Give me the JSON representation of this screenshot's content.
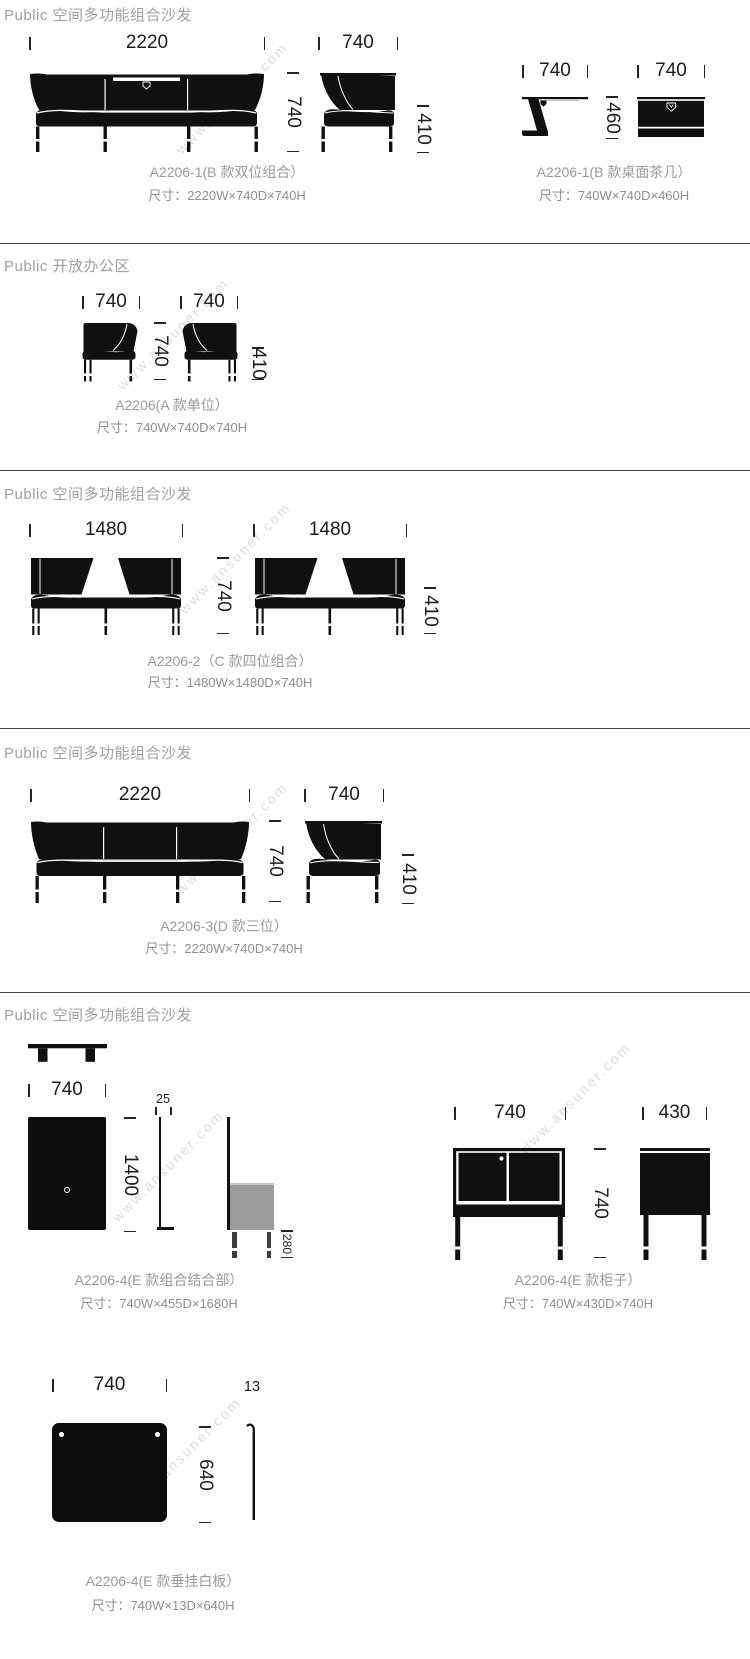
{
  "watermark": "www.ansuner.com",
  "sections": [
    {
      "title": "Public 空间多功能组合沙发",
      "groups": [
        {
          "name": "A2206-1(B 款双位组合）",
          "size": "尺寸：2220W×740D×740H",
          "dims": {
            "width": "2220",
            "height": "740",
            "side_width": "740",
            "seat_height": "410"
          }
        },
        {
          "name": "A2206-1(B 款桌面茶几）",
          "size": "尺寸：740W×740D×460H",
          "dims": {
            "side_width": "740",
            "front_width": "740",
            "height": "460"
          }
        }
      ]
    },
    {
      "title": "Public 开放办公区",
      "groups": [
        {
          "name": "A2206(A 款单位）",
          "size": "尺寸：740W×740D×740H",
          "dims": {
            "front_width": "740",
            "side_width": "740",
            "height": "740",
            "seat_height": "410"
          }
        }
      ]
    },
    {
      "title": "Public 空间多功能组合沙发",
      "groups": [
        {
          "name": "A2206-2（C 款四位组合）",
          "size": "尺寸：1480W×1480D×740H",
          "dims": {
            "width_a": "1480",
            "width_b": "1480",
            "height": "740",
            "seat_height": "410"
          }
        }
      ]
    },
    {
      "title": "Public 空间多功能组合沙发",
      "groups": [
        {
          "name": "A2206-3(D 款三位）",
          "size": "尺寸：2220W×740D×740H",
          "dims": {
            "width": "2220",
            "side_width": "740",
            "height": "740",
            "seat_height": "410"
          }
        }
      ]
    },
    {
      "title": "Public 空间多功能组合沙发",
      "groups": [
        {
          "name": "A2206-4(E 款组合结合部）",
          "size": "尺寸：740W×455D×1680H",
          "dims": {
            "width": "740",
            "panel_height": "1400",
            "thickness": "25",
            "cabinet_height": "280"
          }
        },
        {
          "name": "A2206-4(E 款柜子）",
          "size": "尺寸：740W×430D×740H",
          "dims": {
            "width": "740",
            "depth": "430",
            "height": "740"
          }
        },
        {
          "name": "A2206-4(E 款垂挂白板）",
          "size": "尺寸：740W×13D×640H",
          "dims": {
            "width": "740",
            "thickness": "13",
            "height": "640"
          }
        }
      ]
    }
  ]
}
